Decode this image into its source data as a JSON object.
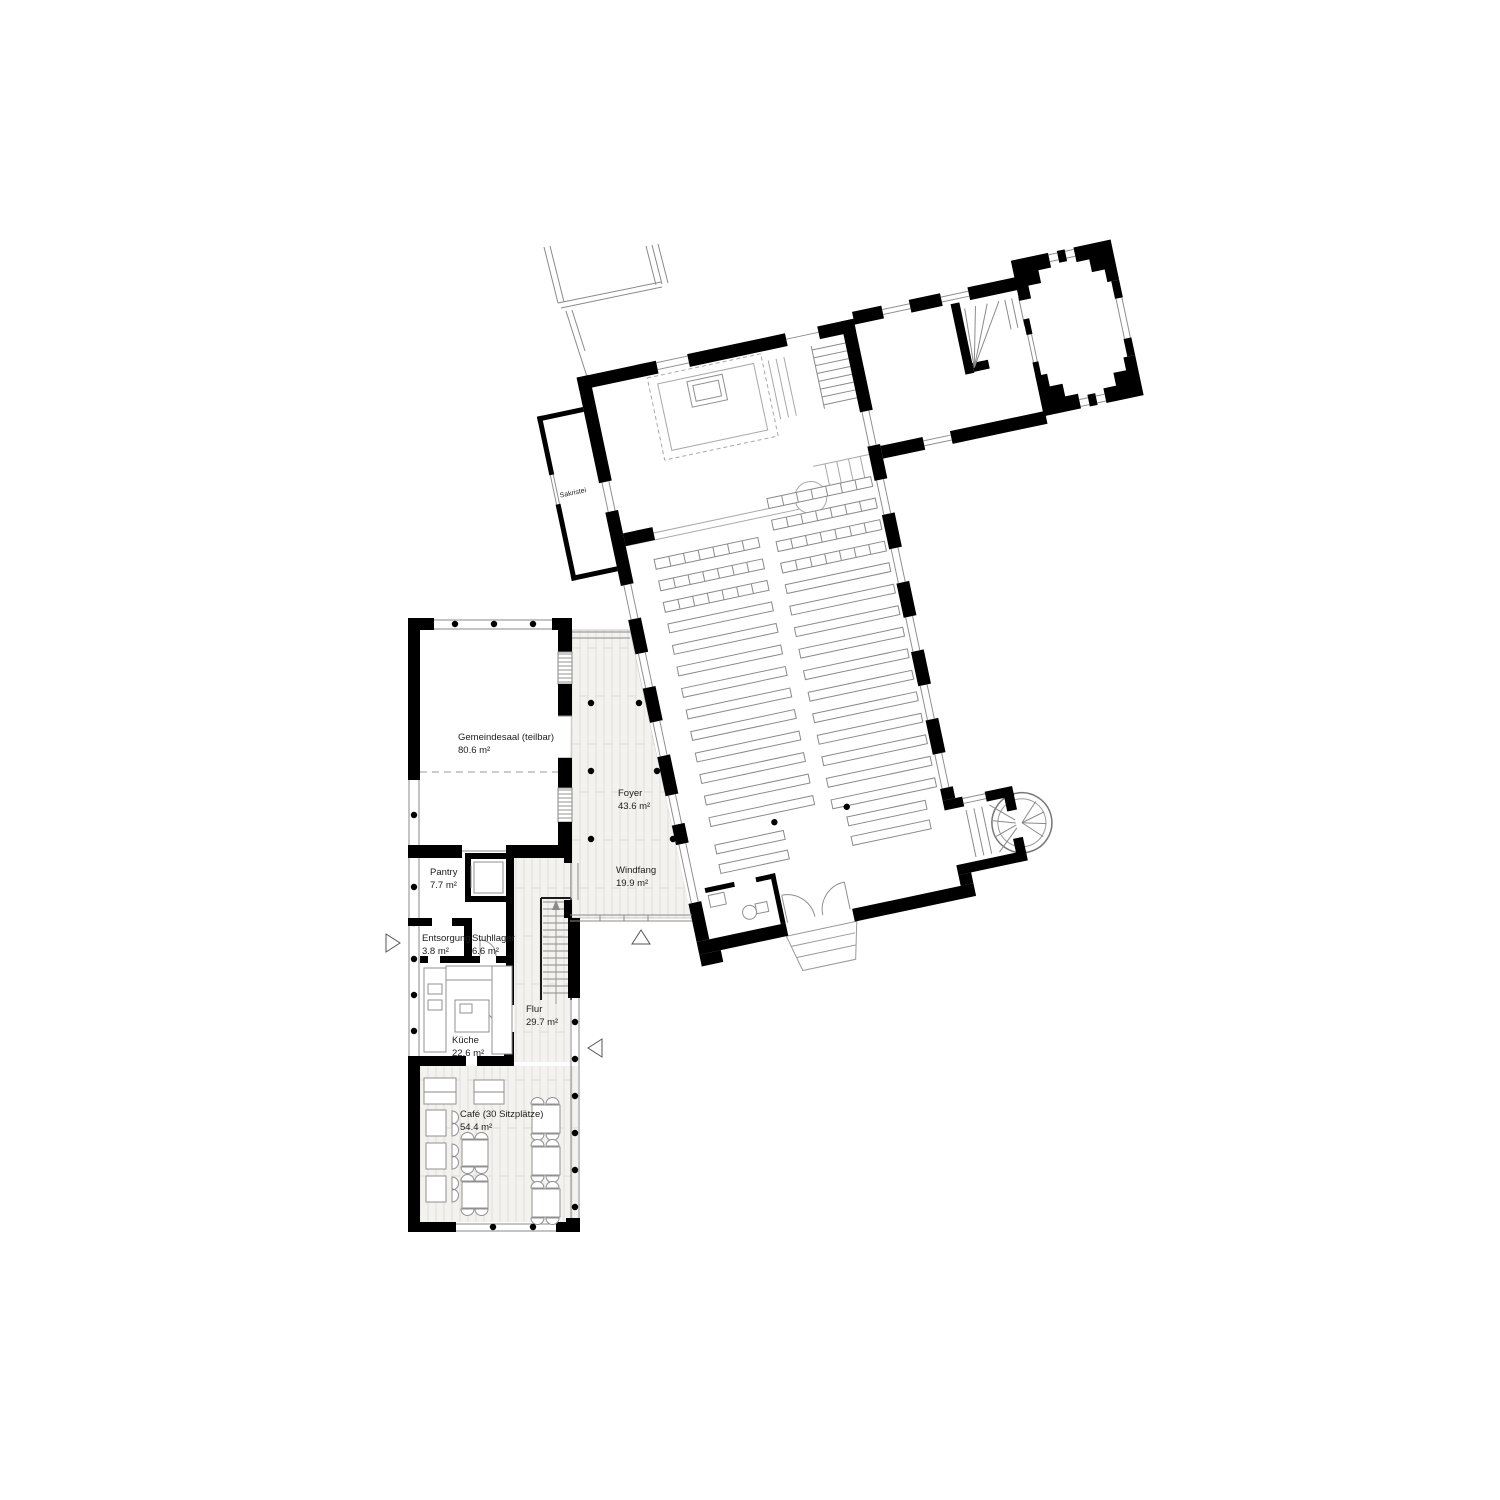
{
  "plan": {
    "rooms": {
      "sakristei": {
        "name": "Sakristei"
      },
      "gemeindesaal": {
        "name": "Gemeindesaal (teilbar)",
        "area": "80.6 m²"
      },
      "foyer": {
        "name": "Foyer",
        "area": "43.6 m²"
      },
      "windfang": {
        "name": "Windfang",
        "area": "19.9 m²"
      },
      "pantry": {
        "name": "Pantry",
        "area": "7.7 m²"
      },
      "entsorgung": {
        "name": "Entsorgung",
        "area": "3.8 m²"
      },
      "stuhllager": {
        "name": "Stuhllager",
        "area": "6.6 m²"
      },
      "kueche": {
        "name": "Küche",
        "area": "22.6 m²"
      },
      "flur": {
        "name": "Flur",
        "area": "29.7 m²"
      },
      "cafe": {
        "name": "Café (30 Sitzplätze)",
        "area": "54.4 m²"
      }
    },
    "colors": {
      "wall": "#000000",
      "line": "#8a8a8a",
      "floor": "#f3f2ef",
      "background": "#ffffff",
      "text": "#1c1c1c"
    }
  }
}
